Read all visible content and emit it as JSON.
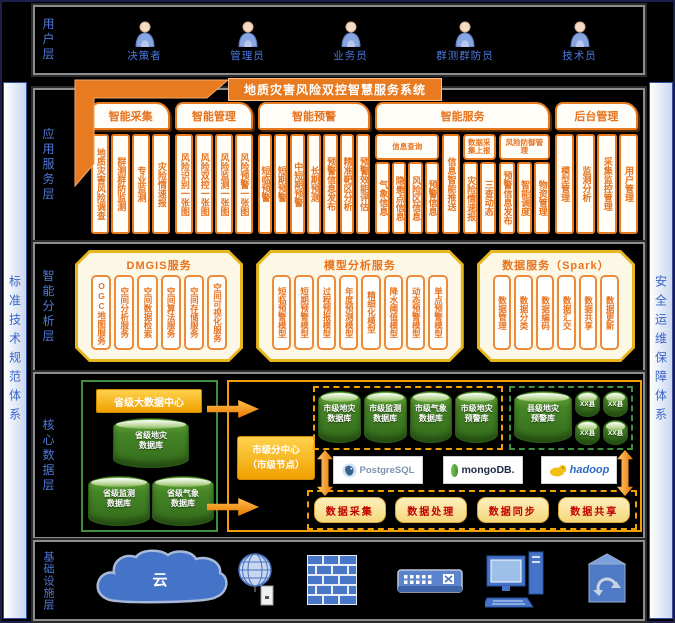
{
  "sidebars": {
    "left": "标准技术规范体系",
    "right": "安全运维保障体系"
  },
  "layers": {
    "user": {
      "label": "用户层",
      "roles": [
        "决策者",
        "管理员",
        "业务员",
        "群测群防员",
        "技术员"
      ]
    },
    "application": {
      "label": "应用服务层",
      "title": "地质灾害风险双控智慧服务系统",
      "groups": [
        {
          "name": "智能采集",
          "columns": [
            "地质灾害风险调查",
            "群测群防监测",
            "专业监测",
            "灾险情速报"
          ]
        },
        {
          "name": "智能管理",
          "columns": [
            "风险识别一张图",
            "风险双控一张图",
            "风险监测一张图",
            "风险预警一张图"
          ]
        },
        {
          "name": "智能预警",
          "columns": [
            "短临预警",
            "短期预警",
            "中短期预警",
            "长期预测",
            "预警信息发布",
            "精准靶区分析",
            "预警效能评估"
          ]
        },
        {
          "name": "智能服务",
          "subgroups": [
            {
              "name": "信息查询",
              "columns": [
                "气象信息",
                "隐患点信息",
                "风险区信息",
                "预警信息"
              ]
            },
            {
              "name": "",
              "columns": [
                "信息智能推送"
              ]
            },
            {
              "name": "数据采集上报",
              "columns": [
                "灾险情速报",
                "三查动态"
              ]
            },
            {
              "name": "风险防御管理",
              "columns": [
                "预警信息发布",
                "智能调度",
                "物资管理"
              ]
            }
          ]
        },
        {
          "name": "后台管理",
          "columns": [
            "模型管理",
            "监测分析",
            "采集监控管理",
            "用户管理"
          ]
        }
      ]
    },
    "analysis": {
      "label": "智能分析层",
      "panels": [
        {
          "title": "DMGIS服务",
          "columns": [
            "OGC地图服务",
            "空间分析服务",
            "空间数据检索",
            "空间算法服务",
            "空间存储服务",
            "空间可视化服务"
          ]
        },
        {
          "title": "模型分析服务",
          "columns": [
            "短临预警模型",
            "短期预警模型",
            "过程预报模型",
            "年度预测模型",
            "精细化模型",
            "降水阈值模型",
            "动态预警模型",
            "单点预警模型"
          ]
        },
        {
          "title": "数据服务（Spark）",
          "columns": [
            "数据管理",
            "数据分类",
            "数据编码",
            "数据汇交",
            "数据共享",
            "数据更新"
          ]
        }
      ]
    },
    "data": {
      "label": "核心数据层",
      "province": {
        "title": "省级大数据中心",
        "dbs": [
          {
            "l1": "省级地灾",
            "l2": "数据库"
          },
          {
            "l1": "省级监测",
            "l2": "数据库"
          },
          {
            "l1": "省级气象",
            "l2": "数据库"
          }
        ]
      },
      "city": {
        "title_l1": "市级分中心",
        "title_l2": "（市级节点）",
        "city_dbs": [
          {
            "l1": "市级地灾",
            "l2": "数据库"
          },
          {
            "l1": "市级监测",
            "l2": "数据库"
          },
          {
            "l1": "市级气象",
            "l2": "数据库"
          },
          {
            "l1": "市级地灾",
            "l2": "预警库"
          }
        ],
        "county_db": {
          "l1": "县级地灾",
          "l2": "预警库"
        },
        "small_dbs": [
          "XX县",
          "XX县",
          "XX县",
          "XX县"
        ],
        "engines": [
          "PostgreSQL",
          "mongoDB.",
          "hadoop"
        ],
        "functions": [
          "数据采集",
          "数据处理",
          "数据同步",
          "数据共享"
        ]
      }
    },
    "infrastructure": {
      "label": "基础设施层",
      "cloud_label": "云"
    }
  }
}
